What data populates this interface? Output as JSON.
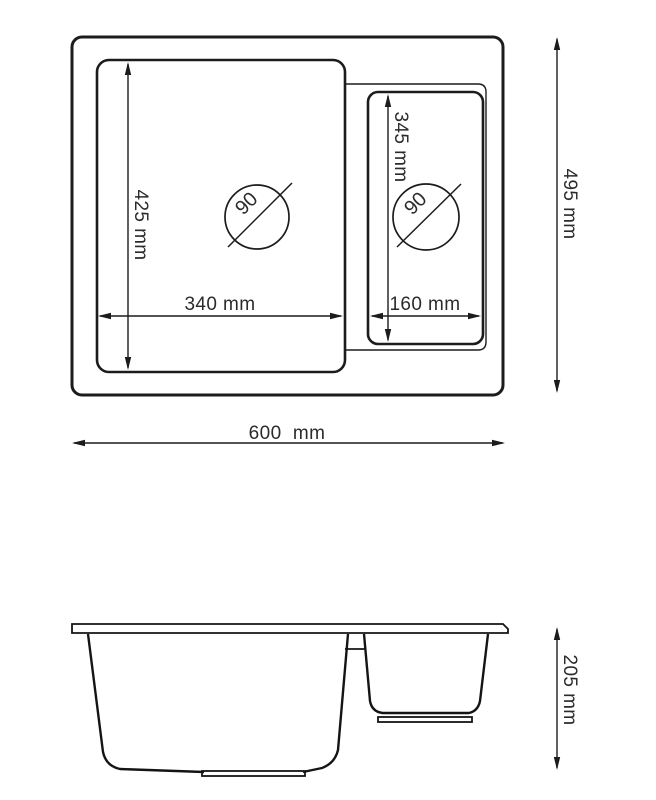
{
  "drawing": {
    "subject": "kitchen-sink-technical-drawing",
    "colors": {
      "background": "#ffffff",
      "line": "#1c1c1c",
      "text": "#2b2b2b"
    },
    "top_view": {
      "dims": {
        "overall_width": "600  mm",
        "overall_depth": "495 mm",
        "main_bowl_depth": "425 mm",
        "main_bowl_width": "340 mm",
        "small_bowl_depth": "345 mm",
        "small_bowl_width": "160 mm",
        "main_drain_diameter": "90",
        "small_drain_diameter": "90"
      }
    },
    "side_view": {
      "dims": {
        "overall_height": "205 mm"
      }
    }
  }
}
